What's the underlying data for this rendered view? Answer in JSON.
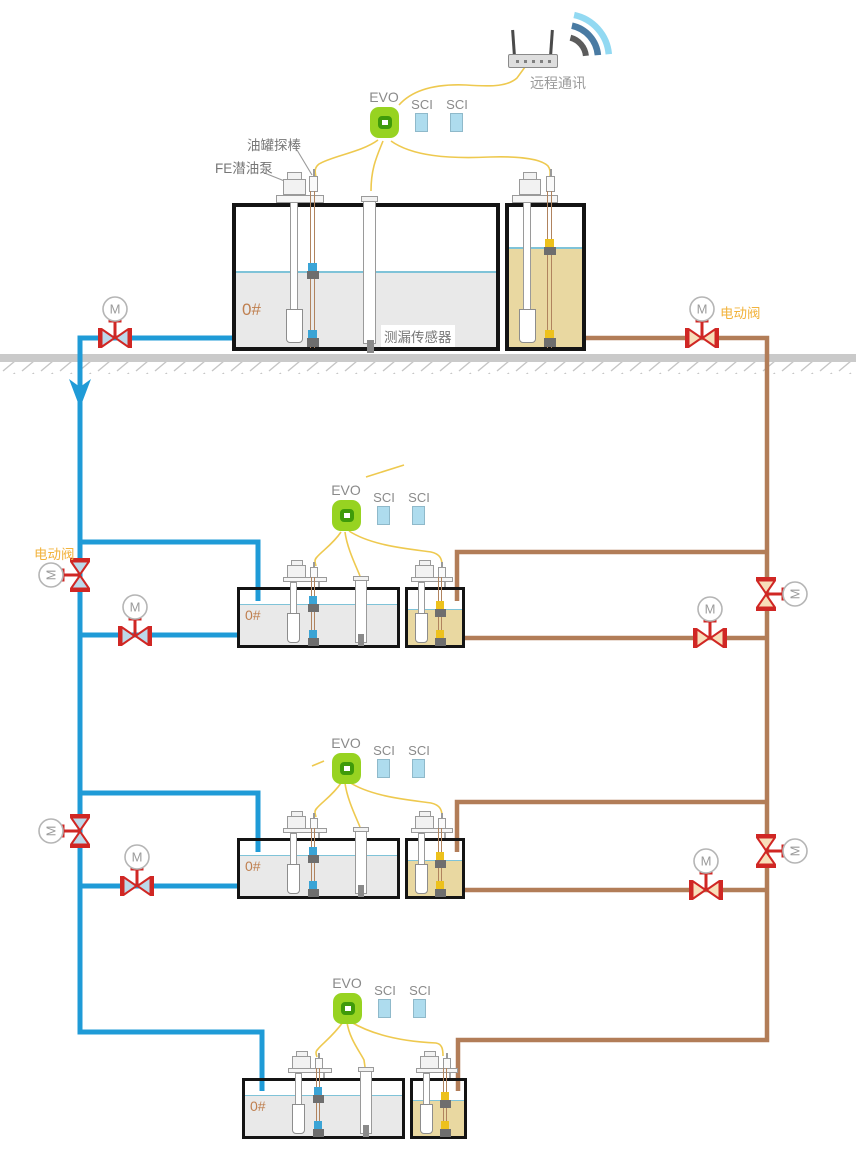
{
  "diagram": {
    "remote_comm_label": "远程通讯",
    "evo_label": "EVO",
    "sci_label": "SCI",
    "tank_probe_label": "油罐探棒",
    "pump_label": "FE潜油泵",
    "leak_sensor_label": "测漏传感器",
    "electric_valve_label": "电动阀",
    "motor_label": "M",
    "tank_number_label": "0#"
  },
  "colors": {
    "supply_pipe": "#1f9bd7",
    "return_pipe": "#b27d58",
    "valve_red": "#d02724",
    "valve_fill_supply": "#bcd9ea",
    "valve_fill_return": "#f8dfba",
    "wire": "#eec94f",
    "evo_green": "#97d321",
    "evo_ring": "#3f9b0a",
    "sci_fill": "#aedcee",
    "fuel_gray": "#e9e9e9",
    "fuel_tan": "#e9d8a1",
    "level_line": "#7fc3d8",
    "orange_label": "#f2b33d",
    "tank_number_color": "#bf7f4f",
    "ground": "#cacaca",
    "wifi_outer": "#92d9f2",
    "wifi_mid": "#4a7ba3",
    "wifi_inner": "#5c5c5c"
  }
}
